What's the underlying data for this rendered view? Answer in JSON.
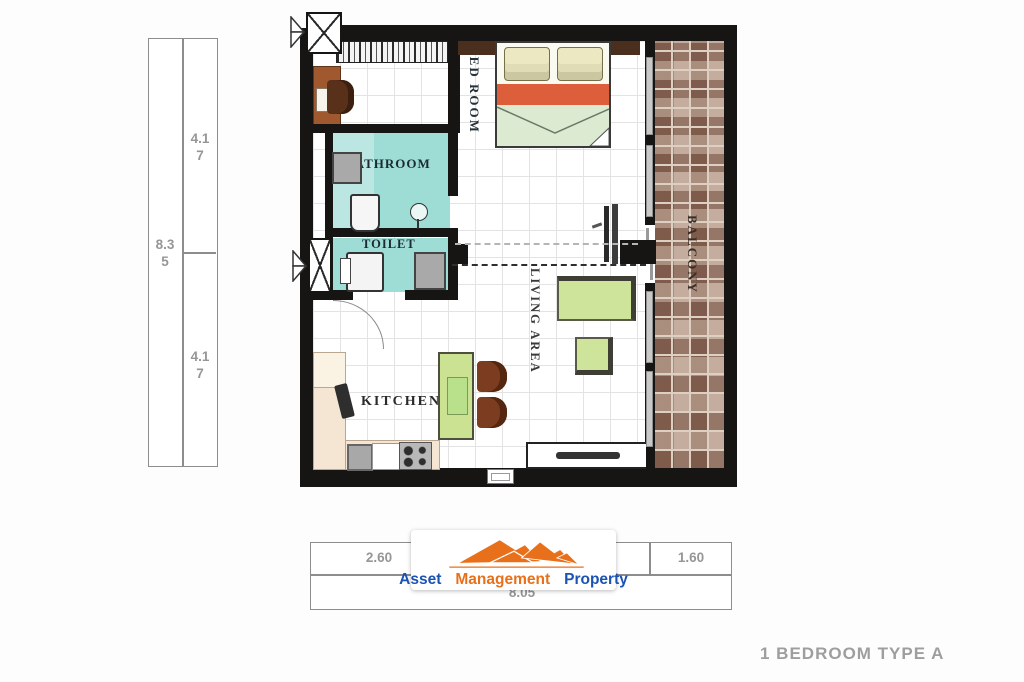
{
  "title": "1 BEDROOM TYPE A",
  "rooms": {
    "bedroom": "BED ROOM",
    "bathroom": "BATHROOM",
    "toilet": "TOILET",
    "kitchen": "KITCHEN",
    "living": "LIVING AREA",
    "balcony": "BALCONY"
  },
  "dimensions": {
    "left": {
      "total_line1": "8.3",
      "total_line2": "5",
      "upper_line1": "4.1",
      "upper_line2": "7",
      "lower_line1": "4.1",
      "lower_line2": "7"
    },
    "bottom": {
      "cell1": "2.60",
      "cell2": "",
      "cell3": "1.60",
      "total": "8.05"
    }
  },
  "logo": {
    "word1": "Asset",
    "word2": "Management",
    "word3": "Property"
  },
  "colors": {
    "wall": "#171513",
    "bathroom_fill": "#9edcd6",
    "bed_blanket": "#dc5e3a",
    "bed_sheet": "#dcead2",
    "furniture_green": "#cfe49b",
    "counter_cream": "#f4e6d2",
    "balcony_tile": "#a28575",
    "logo_orange": "#e8701a",
    "logo_blue": "#1b53b4",
    "dimension_text": "#969696",
    "title_text": "#9e9e9e"
  }
}
